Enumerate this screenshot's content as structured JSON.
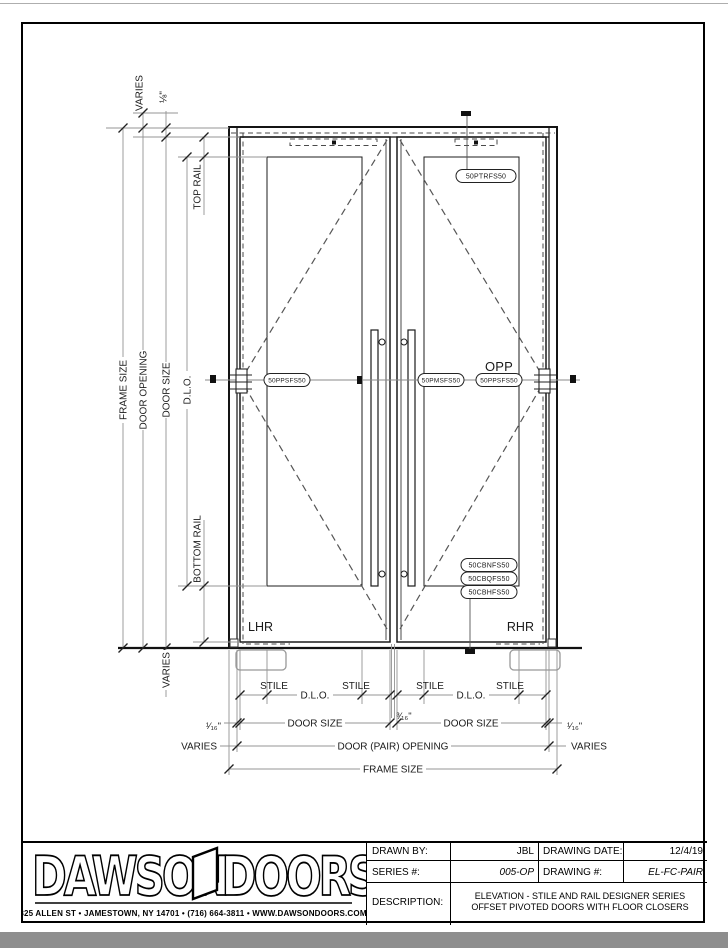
{
  "drawing": {
    "parts": {
      "top_rail": "50PTRFS50",
      "pivot_stile": "50PPSFS50",
      "meeting_stile": "50PMSFS50",
      "opp_marker": "OPP",
      "opp_pivot_stile": "50PPSFS50",
      "floor_closer_1": "50CBNFS50",
      "floor_closer_2": "50CBQFS50",
      "floor_closer_3": "50CBHFS50"
    },
    "handing": {
      "left": "LHR",
      "right": "RHR"
    },
    "dims_vertical": {
      "frame_size": "FRAME SIZE",
      "door_opening": "DOOR OPENING",
      "door_size": "DOOR SIZE",
      "dlo": "D.L.O.",
      "varies": "VARIES",
      "head_gap": "⅛\"",
      "top_rail": "TOP RAIL",
      "bottom_rail": "BOTTOM RAIL",
      "floor_varies": "VARIES"
    },
    "dims_horizontal": {
      "stile": "STILE",
      "dlo": "D.L.O.",
      "door_size": "DOOR SIZE",
      "edge_gap": "¹⁄₁₆\"",
      "meeting_gap": "³⁄₁₆\"",
      "varies": "VARIES",
      "door_pair_opening": "DOOR (PAIR) OPENING",
      "frame_size": "FRAME SIZE"
    }
  },
  "titleblock": {
    "logo_word1": "DAWSON",
    "logo_word2": "DOORS",
    "address": "825 ALLEN ST • JAMESTOWN, NY 14701 • (716) 664-3811 • WWW.DAWSONDOORS.COM",
    "drawn_by_label": "DRAWN BY:",
    "drawn_by": "JBL",
    "drawing_date_label": "DRAWING DATE:",
    "drawing_date": "12/4/19",
    "series_label": "SERIES #:",
    "series": "005-OP",
    "drawing_no_label": "DRAWING #:",
    "drawing_no": "EL-FC-PAIR",
    "description_label": "DESCRIPTION:",
    "description": "ELEVATION - STILE AND RAIL DESIGNER SERIES OFFSET PIVOTED DOORS WITH FLOOR CLOSERS"
  }
}
